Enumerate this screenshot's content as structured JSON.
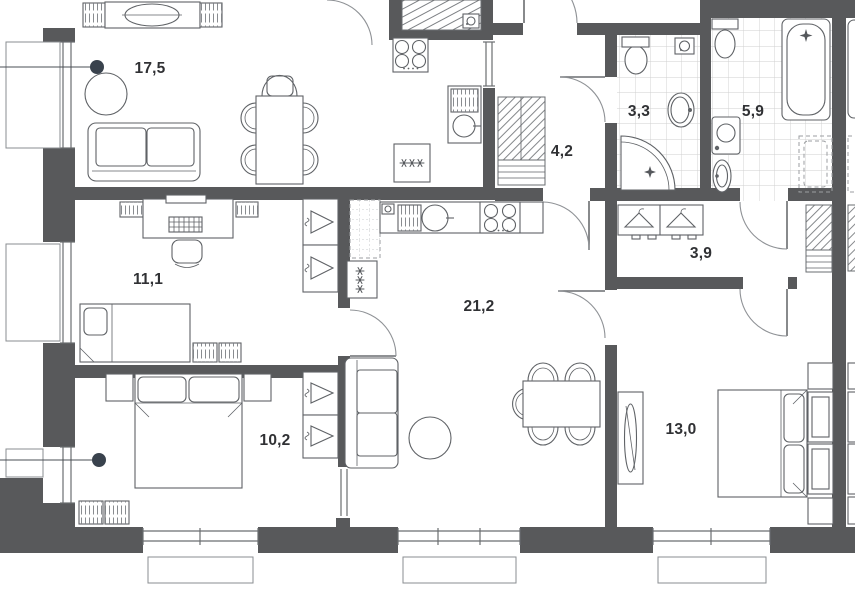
{
  "plan_title": "apartment-floor-plan",
  "rooms": {
    "living": {
      "label": "17,5"
    },
    "study": {
      "label": "11,1"
    },
    "bedroom_small": {
      "label": "10,2"
    },
    "kitchen_living": {
      "label": "21,2"
    },
    "hallway": {
      "label": "4,2"
    },
    "bathroom_shower": {
      "label": "3,3"
    },
    "bathroom_bath": {
      "label": "5,9"
    },
    "wardrobe_hall": {
      "label": "3,9"
    },
    "bedroom_master": {
      "label": "13,0"
    }
  },
  "colors": {
    "wall": "#58595b",
    "line": "#5f6266",
    "tile": "#cfcfcf",
    "callout": "#39424d",
    "background": "#ffffff"
  }
}
